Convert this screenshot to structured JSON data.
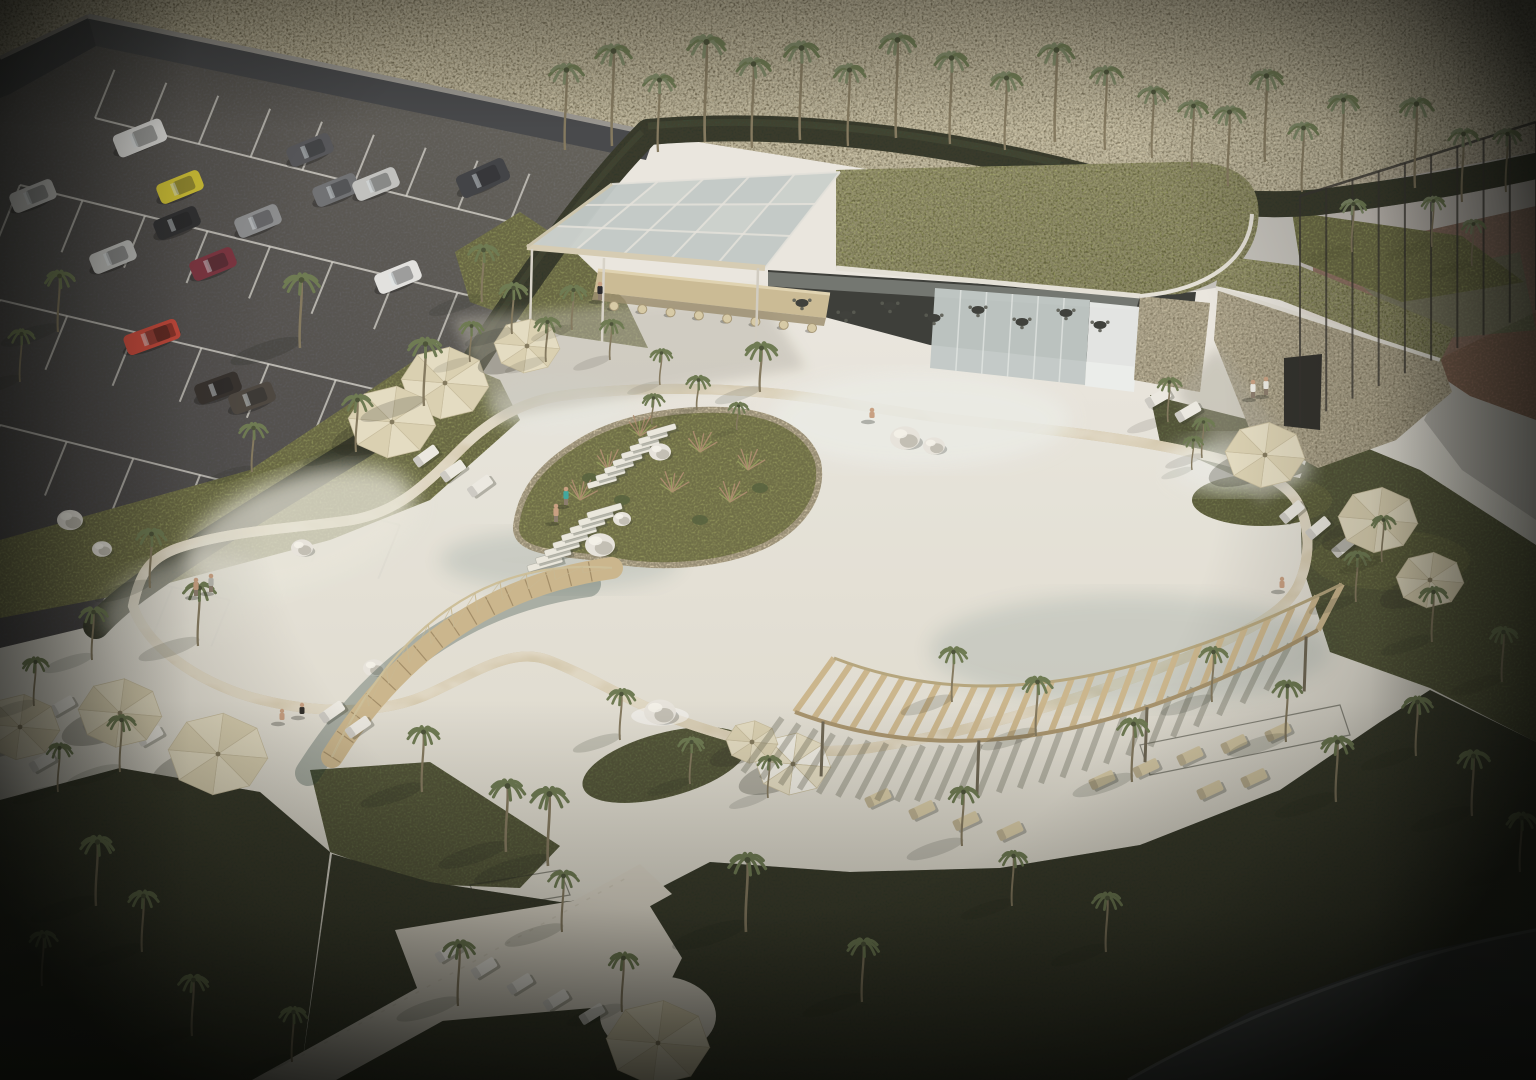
{
  "meta": {
    "title": "Aerial 3D architectural rendering of a resort lagoon pool with bar pavilion, palm trees and parking lot",
    "width": 1536,
    "height": 1080
  },
  "palette": {
    "plaza": "#e8e5dd",
    "plazaShade": "#c2bfb2",
    "hillA": "#a39978",
    "hillB": "#c6bc9e",
    "asphaltA": "#6e6d69",
    "asphaltB": "#45444a",
    "line": "#dedcd4",
    "wallFace": "#45474a",
    "wallTop": "#9b9893",
    "hedge": "#2c3527",
    "hedgeHi": "#45523a",
    "grass": "#878c55",
    "grassShade": "#5d6540",
    "grassDark": "#2e3626",
    "waterA": "#63c5c2",
    "waterB": "#a4dbd6",
    "sand": "#d8cdb0",
    "ring": "#d2c6a8",
    "wood": "#cdb88e",
    "woodDark": "#a8946e",
    "umbrella": "#e7dfc5",
    "umbrellaAlt": "#dcd3b4",
    "umbrellaLine": "#c9bfa0",
    "roofA": "#8f9457",
    "roofB": "#747a41",
    "fascia": "#e6e3da",
    "glass": "#c3cbc9",
    "interior": "#3a3c38",
    "stone": "#b2a78c",
    "court": "#96705e",
    "courtGreen": "#7d8161",
    "road": "#c7c5bf",
    "pathDark": "#43474a",
    "loungerW": "#eeece4",
    "loungerB": "#d9cca8",
    "rock": "#eae7df",
    "rockShade": "#b4b0a5",
    "trunk": "#84795f",
    "frond": "#6d7a52",
    "frondGray": "#7e8a68",
    "skin": "#c9a183"
  },
  "scene": {
    "palms": [
      [
        565,
        150,
        80,
        17,
        "g",
        0
      ],
      [
        612,
        146,
        95,
        18,
        "g",
        0
      ],
      [
        658,
        152,
        72,
        16,
        "g",
        0
      ],
      [
        705,
        142,
        100,
        19,
        "g",
        0
      ],
      [
        752,
        148,
        84,
        17,
        "g",
        0
      ],
      [
        800,
        140,
        92,
        18,
        "g",
        0
      ],
      [
        848,
        146,
        76,
        16,
        "g",
        0
      ],
      [
        896,
        138,
        98,
        18,
        "g",
        0
      ],
      [
        950,
        144,
        86,
        17,
        "g",
        0
      ],
      [
        1005,
        150,
        72,
        16,
        "g",
        0
      ],
      [
        1055,
        142,
        92,
        18,
        "g",
        0
      ],
      [
        1105,
        150,
        78,
        16,
        "g",
        0
      ],
      [
        1152,
        158,
        66,
        15,
        "g",
        0
      ],
      [
        1192,
        168,
        62,
        15,
        "g",
        0
      ],
      [
        1228,
        186,
        74,
        16,
        "g",
        0
      ],
      [
        1265,
        162,
        86,
        17,
        "g",
        0
      ],
      [
        1302,
        192,
        64,
        15,
        "g",
        0
      ],
      [
        1342,
        178,
        78,
        16,
        "g",
        0
      ],
      [
        1415,
        188,
        84,
        17,
        "g",
        0
      ],
      [
        1462,
        202,
        68,
        15,
        "g",
        0
      ],
      [
        1506,
        192,
        58,
        14,
        "g",
        0
      ],
      [
        1352,
        252,
        48,
        13,
        "g",
        0.3
      ],
      [
        1432,
        247,
        46,
        12,
        "g",
        0.3
      ],
      [
        1472,
        266,
        42,
        12,
        "g",
        0.3
      ],
      [
        300,
        348,
        68,
        18,
        "d",
        0.8
      ],
      [
        424,
        406,
        62,
        17,
        "d",
        0.8
      ],
      [
        356,
        452,
        52,
        15,
        "d",
        0.7
      ],
      [
        252,
        472,
        44,
        14,
        "d",
        0.6
      ],
      [
        58,
        332,
        56,
        15,
        "d",
        0.6
      ],
      [
        20,
        382,
        48,
        13,
        "d",
        0.5
      ],
      [
        482,
        302,
        52,
        15,
        "d",
        0.6
      ],
      [
        512,
        334,
        46,
        14,
        "d",
        0.6
      ],
      [
        546,
        362,
        40,
        13,
        "d",
        0.5
      ],
      [
        470,
        362,
        36,
        12,
        "d",
        0.5
      ],
      [
        572,
        330,
        40,
        13,
        "d",
        0.5
      ],
      [
        610,
        360,
        36,
        12,
        "d",
        0.5
      ],
      [
        660,
        385,
        32,
        11,
        "d",
        0.4
      ],
      [
        760,
        392,
        44,
        16,
        "d",
        0.6
      ],
      [
        652,
        424,
        26,
        11,
        "d",
        0.4
      ],
      [
        697,
        410,
        30,
        12,
        "d",
        0.4
      ],
      [
        737,
        430,
        24,
        10,
        "d",
        0.4
      ],
      [
        150,
        588,
        54,
        15,
        "d",
        0.7
      ],
      [
        198,
        646,
        58,
        16,
        "d",
        0.7
      ],
      [
        92,
        660,
        48,
        14,
        "d",
        0.6
      ],
      [
        34,
        706,
        44,
        13,
        "d",
        0.6
      ],
      [
        120,
        772,
        52,
        14,
        "d",
        0.7
      ],
      [
        58,
        792,
        44,
        13,
        "d",
        0.6
      ],
      [
        96,
        906,
        64,
        17,
        "d",
        0.8
      ],
      [
        142,
        952,
        56,
        15,
        "d",
        0.7
      ],
      [
        42,
        986,
        50,
        14,
        "d",
        0.6
      ],
      [
        192,
        1036,
        56,
        15,
        "d",
        0.7
      ],
      [
        292,
        1062,
        50,
        14,
        "d",
        0.6
      ],
      [
        422,
        792,
        60,
        16,
        "d",
        0.8
      ],
      [
        506,
        852,
        66,
        18,
        "d",
        0.8
      ],
      [
        548,
        866,
        72,
        19,
        "d",
        0.8
      ],
      [
        562,
        932,
        56,
        15,
        "d",
        0.7
      ],
      [
        458,
        1006,
        60,
        16,
        "d",
        0.7
      ],
      [
        622,
        1012,
        54,
        15,
        "d",
        0.6
      ],
      [
        746,
        932,
        72,
        19,
        "d",
        0.8
      ],
      [
        862,
        1002,
        58,
        16,
        "d",
        0.7
      ],
      [
        962,
        846,
        54,
        15,
        "d",
        0.7
      ],
      [
        1012,
        906,
        50,
        14,
        "d",
        0.6
      ],
      [
        1106,
        952,
        54,
        15,
        "d",
        0.6
      ],
      [
        620,
        740,
        46,
        14,
        "d",
        0.7
      ],
      [
        690,
        784,
        42,
        13,
        "d",
        0.6
      ],
      [
        768,
        798,
        38,
        12,
        "d",
        0.6
      ],
      [
        952,
        702,
        50,
        14,
        "d",
        0.7
      ],
      [
        1036,
        736,
        54,
        15,
        "d",
        0.7
      ],
      [
        1132,
        782,
        58,
        16,
        "d",
        0.7
      ],
      [
        1212,
        702,
        50,
        14,
        "d",
        0.7
      ],
      [
        1286,
        742,
        56,
        15,
        "d",
        0.7
      ],
      [
        1336,
        802,
        60,
        16,
        "d",
        0.7
      ],
      [
        1416,
        756,
        54,
        15,
        "d",
        0.7
      ],
      [
        1472,
        816,
        60,
        16,
        "d",
        0.6
      ],
      [
        1520,
        872,
        54,
        15,
        "d",
        0.5
      ],
      [
        1356,
        602,
        46,
        13,
        "d",
        0.6
      ],
      [
        1432,
        642,
        50,
        14,
        "d",
        0.6
      ],
      [
        1502,
        682,
        50,
        14,
        "d",
        0.5
      ],
      [
        1382,
        562,
        42,
        12,
        "d",
        0.5
      ],
      [
        1168,
        422,
        40,
        12,
        "d",
        0.5
      ],
      [
        1202,
        458,
        36,
        11,
        "d",
        0.5
      ],
      [
        1192,
        470,
        30,
        10,
        "d",
        0.4
      ]
    ],
    "umbrellas": [
      [
        445,
        383,
        44,
        "p"
      ],
      [
        392,
        422,
        44,
        "p"
      ],
      [
        527,
        346,
        33,
        "p"
      ],
      [
        218,
        754,
        50,
        "p"
      ],
      [
        120,
        713,
        42,
        "p"
      ],
      [
        20,
        727,
        40,
        "p"
      ],
      [
        658,
        1043,
        52,
        "p"
      ],
      [
        793,
        764,
        38,
        "s"
      ],
      [
        752,
        742,
        26,
        "p"
      ],
      [
        1265,
        455,
        40,
        "p"
      ],
      [
        1378,
        520,
        40,
        "p"
      ],
      [
        1430,
        580,
        34,
        "p"
      ]
    ],
    "cars": [
      [
        140,
        138,
        -22,
        "#e6e6e4",
        "van"
      ],
      [
        33,
        196,
        -22,
        "#c8c8c6",
        ""
      ],
      [
        180,
        187,
        -22,
        "#d4c535",
        ""
      ],
      [
        310,
        150,
        -22,
        "#55565a",
        ""
      ],
      [
        336,
        190,
        -22,
        "#6f7174",
        ""
      ],
      [
        376,
        184,
        -22,
        "#c2c3c1",
        ""
      ],
      [
        177,
        223,
        -22,
        "#2e2f31",
        ""
      ],
      [
        258,
        221,
        -22,
        "#8e9092",
        ""
      ],
      [
        113,
        257,
        -22,
        "#c6c7c5",
        ""
      ],
      [
        213,
        264,
        -22,
        "#7c3340",
        ""
      ],
      [
        152,
        337,
        -20,
        "#c8473a",
        "pickup"
      ],
      [
        398,
        277,
        -22,
        "#e4e4e2",
        ""
      ],
      [
        483,
        178,
        -24,
        "#3f4145",
        "van"
      ],
      [
        218,
        388,
        -20,
        "#332f2c",
        ""
      ],
      [
        252,
        398,
        -20,
        "#4a453f",
        ""
      ]
    ],
    "loungers": [
      [
        372,
        426,
        -36,
        "w"
      ],
      [
        399,
        441,
        -36,
        "w"
      ],
      [
        426,
        456,
        -36,
        "w"
      ],
      [
        453,
        471,
        -36,
        "w"
      ],
      [
        480,
        486,
        -36,
        "w"
      ],
      [
        62,
        706,
        -30,
        "w"
      ],
      [
        96,
        724,
        -30,
        "w"
      ],
      [
        42,
        762,
        -30,
        "w"
      ],
      [
        150,
        736,
        -30,
        "w"
      ],
      [
        332,
        712,
        -35,
        "w"
      ],
      [
        358,
        727,
        -35,
        "w"
      ],
      [
        448,
        952,
        -32,
        "w"
      ],
      [
        484,
        968,
        -32,
        "w"
      ],
      [
        520,
        984,
        -32,
        "w"
      ],
      [
        556,
        1000,
        -32,
        "w"
      ],
      [
        592,
        1014,
        -32,
        "w"
      ],
      [
        1292,
        512,
        -40,
        "w"
      ],
      [
        1318,
        528,
        -40,
        "w"
      ],
      [
        1344,
        546,
        -40,
        "w"
      ],
      [
        1158,
        398,
        -30,
        "w"
      ],
      [
        1188,
        412,
        -30,
        "w"
      ],
      [
        878,
        798,
        -25,
        "b"
      ],
      [
        922,
        810,
        -25,
        "b"
      ],
      [
        966,
        821,
        -25,
        "b"
      ],
      [
        1010,
        831,
        -25,
        "b"
      ],
      [
        1102,
        780,
        -25,
        "b"
      ],
      [
        1146,
        768,
        -25,
        "b"
      ],
      [
        1190,
        756,
        -25,
        "b"
      ],
      [
        1234,
        744,
        -25,
        "b"
      ],
      [
        1278,
        732,
        -25,
        "b"
      ],
      [
        1210,
        790,
        -25,
        "b"
      ],
      [
        1254,
        778,
        -25,
        "b"
      ]
    ],
    "people": [
      [
        196,
        596,
        "stand",
        "#c9a183"
      ],
      [
        211,
        592,
        "stand",
        "#b8b8b0"
      ],
      [
        282,
        722,
        "sit",
        "#caa183"
      ],
      [
        302,
        716,
        "sit",
        "#2e2c28"
      ],
      [
        872,
        420,
        "wade",
        "#c9a183"
      ],
      [
        600,
        300,
        "stand",
        "#26262a"
      ],
      [
        1253,
        398,
        "stand",
        "#f0efe8"
      ],
      [
        1266,
        395,
        "stand",
        "#f0efe8"
      ],
      [
        1282,
        590,
        "sit",
        "#caa183"
      ],
      [
        566,
        505,
        "stand",
        "#3fa8a0"
      ],
      [
        556,
        522,
        "stand",
        "#caa183"
      ]
    ],
    "rocks": [
      [
        905,
        438,
        15,
        0
      ],
      [
        934,
        446,
        11,
        0
      ],
      [
        660,
        712,
        16,
        1
      ],
      [
        600,
        545,
        15,
        0
      ],
      [
        660,
        452,
        11,
        0
      ],
      [
        302,
        548,
        11,
        0
      ],
      [
        374,
        668,
        11,
        0
      ],
      [
        70,
        520,
        13,
        0
      ],
      [
        102,
        549,
        10,
        0
      ],
      [
        622,
        519,
        9,
        0
      ]
    ],
    "parking_rows": [
      [
        95,
        118,
        510,
        222,
        8,
        52,
        -68
      ],
      [
        20,
        185,
        520,
        308,
        8,
        56,
        112
      ],
      [
        0,
        300,
        470,
        412,
        7,
        58,
        112
      ],
      [
        0,
        425,
        400,
        525,
        6,
        58,
        112
      ],
      [
        0,
        548,
        230,
        600,
        4,
        50,
        112
      ]
    ],
    "stools": {
      "n": 8,
      "x1": 614,
      "y1": 306,
      "x2": 812,
      "y2": 328
    },
    "tables": [
      [
        802,
        303
      ],
      [
        846,
        315
      ],
      [
        890,
        306
      ],
      [
        934,
        318
      ],
      [
        978,
        310
      ],
      [
        1022,
        322
      ],
      [
        1066,
        313
      ],
      [
        1100,
        325
      ]
    ],
    "canopy": {
      "quad": [
        612,
        184,
        840,
        172,
        765,
        268,
        527,
        247
      ],
      "cols": 5,
      "rows": 3
    },
    "glasswall": {
      "quad": [
        935,
        288,
        1090,
        300,
        1085,
        385,
        930,
        368
      ],
      "n": 5
    },
    "fence": {
      "x1": 1300,
      "yt1": 196,
      "yb1": 424,
      "x2": 1536,
      "yt2": 122,
      "yb2": 310,
      "n": 10
    },
    "pergola": {
      "front": [
        795,
        712,
        950,
        770,
        1120,
        740,
        1318,
        630
      ],
      "back": [
        834,
        658,
        974,
        712,
        1132,
        688,
        1342,
        584
      ],
      "slats": 26,
      "columns": [
        0.06,
        0.38,
        0.7,
        0.98
      ]
    },
    "bridge": {
      "x1": 332,
      "y1": 757,
      "cx": 436,
      "cy": 592,
      "x2": 612,
      "y2": 568,
      "w": 22,
      "planks": 16,
      "rail_dy": -40
    },
    "stairs": [
      {
        "x": 545,
        "y": 564,
        "n": 8,
        "dx": 8.5,
        "dy": -7.6,
        "w": 36,
        "h": 6.5,
        "rot": -16
      },
      {
        "x": 602,
        "y": 482,
        "n": 8,
        "dx": 8.5,
        "dy": -7.4,
        "w": 30,
        "h": 6,
        "rot": -16
      }
    ],
    "reeds": [
      [
        640,
        436
      ],
      [
        700,
        452
      ],
      [
        748,
        470
      ],
      [
        608,
        470
      ],
      [
        672,
        492
      ],
      [
        730,
        502
      ],
      [
        580,
        500
      ]
    ],
    "bushes": [
      [
        622,
        500
      ],
      [
        700,
        520
      ],
      [
        760,
        488
      ],
      [
        590,
        478
      ]
    ],
    "wires": [
      [
        1140,
        745,
        1340,
        705,
        1350,
        735,
        1150,
        775
      ],
      [
        470,
        885,
        560,
        870,
        570,
        895,
        480,
        910
      ]
    ]
  }
}
